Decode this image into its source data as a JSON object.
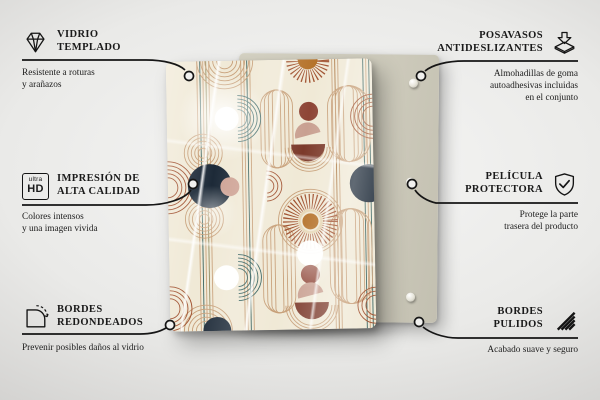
{
  "colors": {
    "background_light": "#f6f6f5",
    "background_dark": "#a5a4a2",
    "text": "#1a1a1a",
    "back_panel": "#cfccbd",
    "glass_cream": "#f0e9d6",
    "pattern_tan": "#c79f78",
    "pattern_rust": "#a0512f",
    "pattern_teal": "#33605e",
    "pattern_navy": "#1d2a38",
    "pattern_brown": "#8e4536",
    "pattern_maroon": "#7c3a2b",
    "pattern_pink": "#cfa496",
    "pattern_ochre": "#b5722a"
  },
  "callouts": {
    "top_left": {
      "icon": "diamond-icon",
      "title_lines": [
        "VIDRIO",
        "TEMPLADO"
      ],
      "description_lines": [
        "Resistente a roturas",
        "y arañazos"
      ]
    },
    "middle_left": {
      "icon": "ultra-hd-icon",
      "icon_text_top": "ultra",
      "icon_text_bottom": "HD",
      "title_lines": [
        "IMPRESIÓN DE",
        "ALTA CALIDAD"
      ],
      "description_lines": [
        "Colores intensos",
        "y una imagen vivida"
      ]
    },
    "bottom_left": {
      "icon": "rounded-corners-icon",
      "title_lines": [
        "BORDES",
        "REDONDEADOS"
      ],
      "description_lines": [
        "Prevenir posibles daños al vidrio"
      ]
    },
    "top_right": {
      "icon": "non-slip-pads-icon",
      "title_lines": [
        "POSAVASOS",
        "ANTIDESLIZANTES"
      ],
      "description_lines": [
        "Almohadillas de goma",
        "autoadhesivas incluidas",
        "en el conjunto"
      ]
    },
    "middle_right": {
      "icon": "shield-check-icon",
      "title_lines": [
        "PELÍCULA",
        "PROTECTORA"
      ],
      "description_lines": [
        "Protege la parte",
        "trasera del producto"
      ]
    },
    "bottom_right": {
      "icon": "polished-edges-icon",
      "title_lines": [
        "BORDES",
        "PULIDOS"
      ],
      "description_lines": [
        "Acabado suave y seguro"
      ]
    }
  }
}
